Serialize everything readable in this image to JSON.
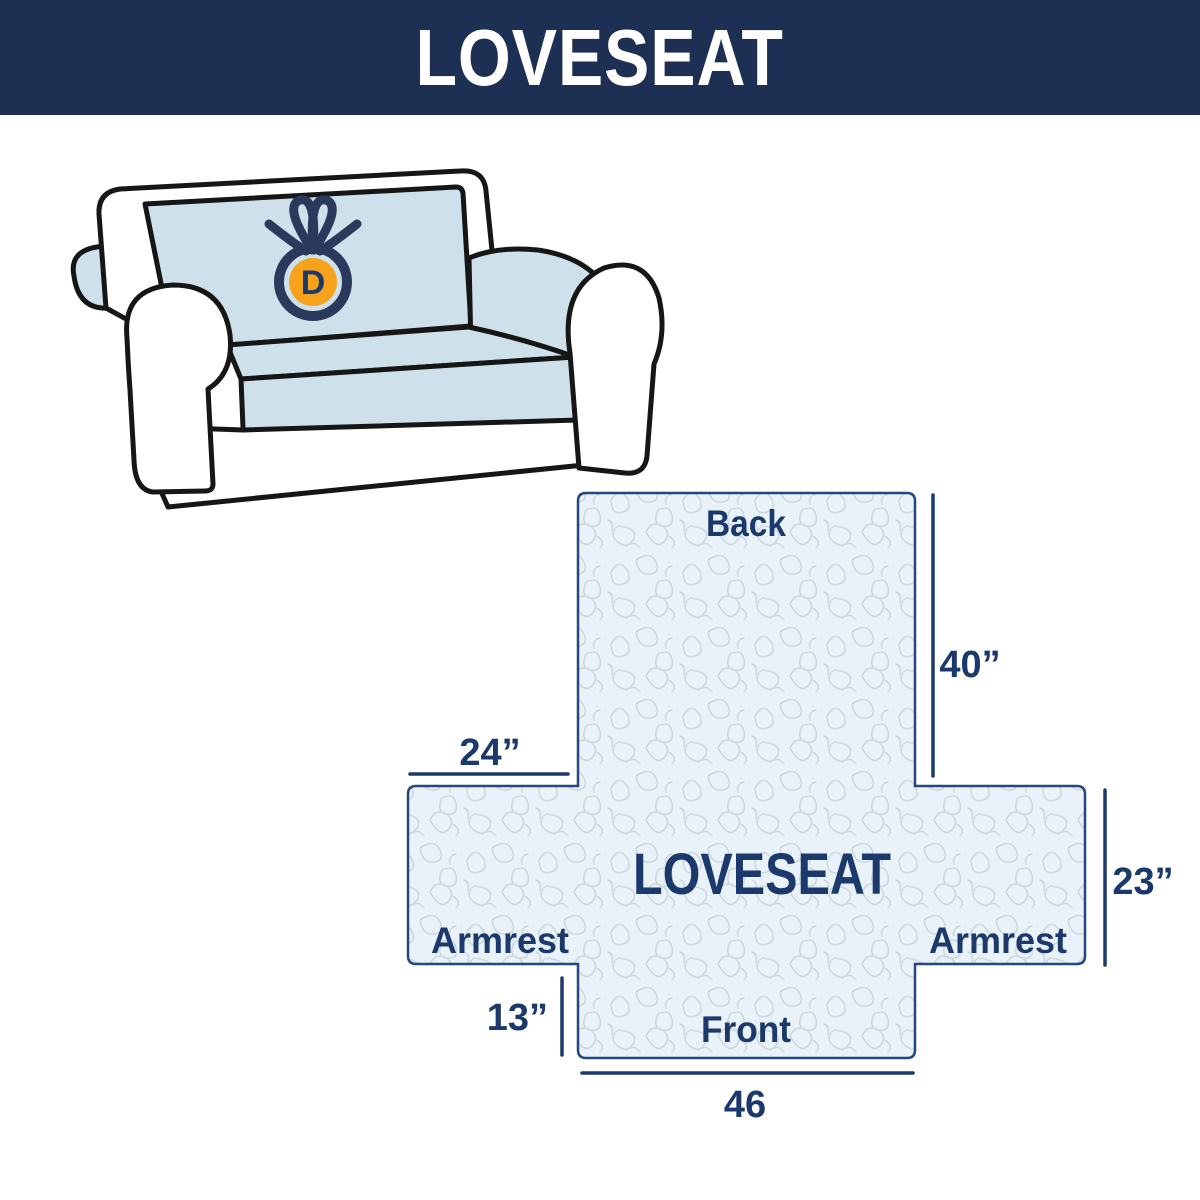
{
  "header": {
    "title": "LOVESEAT"
  },
  "sofa": {
    "description": "loveseat sofa illustration with light blue slipcover",
    "logo_letter": "D"
  },
  "diagram": {
    "center_label": "LOVESEAT",
    "back_label": "Back",
    "front_label": "Front",
    "left_armrest_label": "Armrest",
    "right_armrest_label": "Armrest",
    "dim_back_height": "40”",
    "dim_armrest_top_width": "24”",
    "dim_armrest_side_height": "23”",
    "dim_front_flap_height": "13”",
    "dim_front_width": "46"
  },
  "colors": {
    "banner_navy": "#1d2f52",
    "label_navy": "#1b3a6b",
    "diagram_border": "#24477e",
    "diagram_fill": "#eaf2f9",
    "pattern_line": "#ccd7de",
    "cover_blue": "#cee1ea",
    "sofa_outline": "#161616",
    "logo_orange": "#f7a21b",
    "logo_navy": "#2b3a5c"
  }
}
